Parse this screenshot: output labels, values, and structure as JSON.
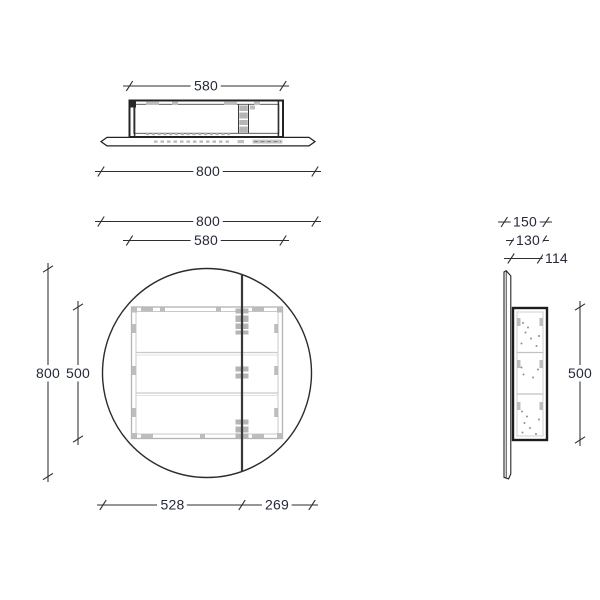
{
  "drawing": {
    "kind": "technical-dimension-drawing",
    "subject": "round-mirror-cabinet",
    "colors": {
      "background": "#ffffff",
      "outline": "#242424",
      "dimension_line": "#2e2e2e",
      "detail_gray": "#b5b5b5",
      "label_text": "#252a38"
    },
    "views": {
      "top": {
        "dim_cabinet_width": "580",
        "dim_overall_width": "800"
      },
      "front": {
        "dim_overall_width": "800",
        "dim_cabinet_width": "580",
        "dim_overall_height": "800",
        "dim_cabinet_height": "500",
        "dim_door_left": "528",
        "dim_door_right": "269"
      },
      "side": {
        "dim_depth_overall": "150",
        "dim_depth_cabinet": "130",
        "dim_depth_inner": "114",
        "dim_cabinet_height": "500"
      }
    }
  }
}
